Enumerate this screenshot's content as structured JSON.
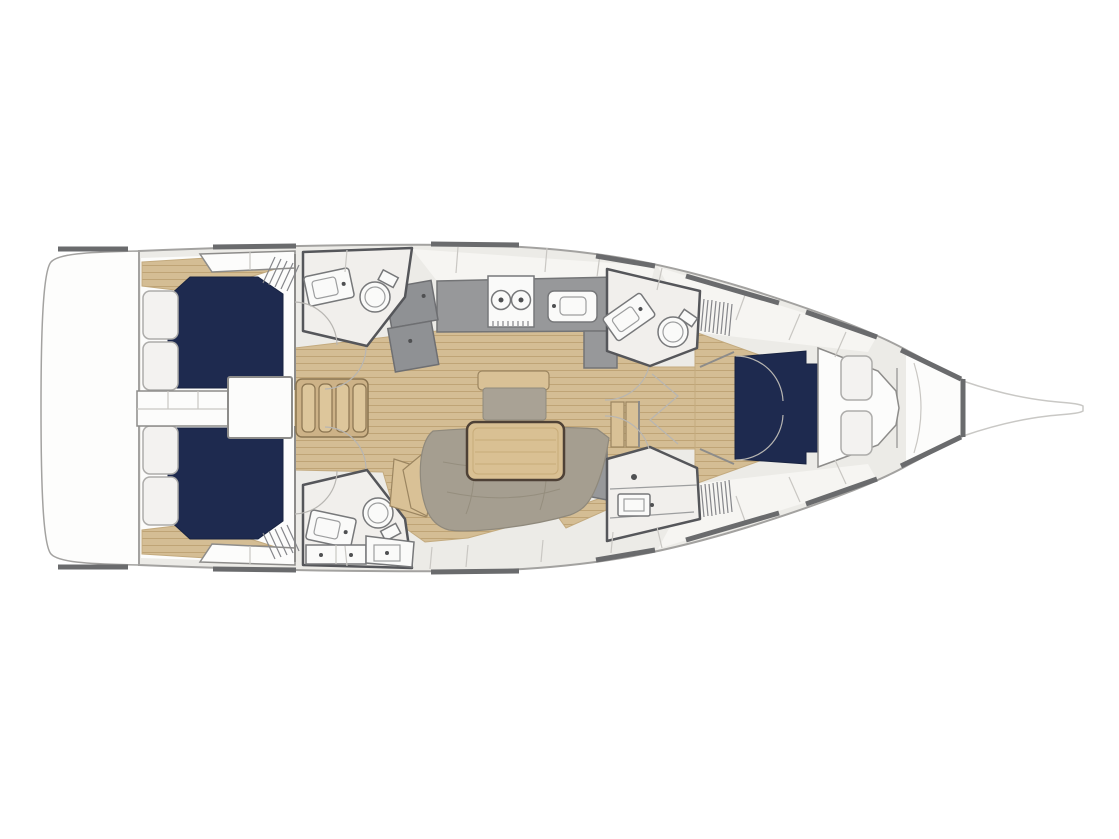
{
  "page": {
    "background_color": "#ffffff"
  },
  "diagram": {
    "type": "boat-interior-floor-plan",
    "orientation": "bow-right-stern-left",
    "colors": {
      "hull_deck": "#ecebe7",
      "hull_outline": "#a3a2a0",
      "rail": "#6a6b6d",
      "wood_base": "#d4bd94",
      "wood_line": "#bfa476",
      "bed_navy": "#1e2a4f",
      "cushion_gray": "#a59e90",
      "bench_gray": "#a9a295",
      "counter_gray": "#97989a",
      "counter_dark": "#8f9194",
      "table_wood": "#d9c093",
      "table_border": "#4e4136",
      "step_wood": "#cdb287",
      "tread_wood": "#ddc69b",
      "room_floor": "#f1efec",
      "room_outline": "#55565a",
      "pillow_fill": "#f3f2f0",
      "pillow_outline": "#adacaa",
      "white_surface": "#fcfcfb",
      "tan_seat": "#d9c196"
    },
    "regions": [
      {
        "name": "swim-platform-transom"
      },
      {
        "name": "aft-port-cabin",
        "features": [
          "double-berth-navy",
          "two-pillows",
          "louver-locker"
        ]
      },
      {
        "name": "aft-starboard-cabin",
        "features": [
          "double-berth-navy",
          "two-pillows",
          "louver-locker"
        ]
      },
      {
        "name": "aft-port-head",
        "features": [
          "sink",
          "toilet"
        ]
      },
      {
        "name": "aft-starboard-head",
        "features": [
          "sink",
          "toilet",
          "drawers",
          "seat"
        ]
      },
      {
        "name": "companionway",
        "features": [
          "four-tread-steps",
          "engine-box",
          "berth-filler"
        ]
      },
      {
        "name": "galley",
        "features": [
          "two-burner-stove",
          "sink",
          "angled-fridge-unit",
          "counter-return"
        ]
      },
      {
        "name": "salon",
        "features": [
          "u-shaped-sofa",
          "wood-table",
          "bench-seat",
          "side-cabinet"
        ]
      },
      {
        "name": "forward-head",
        "features": [
          "sink",
          "toilet",
          "louver-locker"
        ]
      },
      {
        "name": "forward-shower-room",
        "features": [
          "sink",
          "shelves",
          "louver-locker"
        ]
      },
      {
        "name": "forward-cabin",
        "features": [
          "double-berth-navy",
          "two-pillows",
          "headboard-platform"
        ]
      },
      {
        "name": "anchor-locker-bow"
      },
      {
        "name": "bowsprit"
      }
    ],
    "counts": {
      "navy_berths": 3,
      "heads": 4,
      "stove_burners": 2,
      "pillows": 6,
      "companionway_treads": 4
    }
  }
}
